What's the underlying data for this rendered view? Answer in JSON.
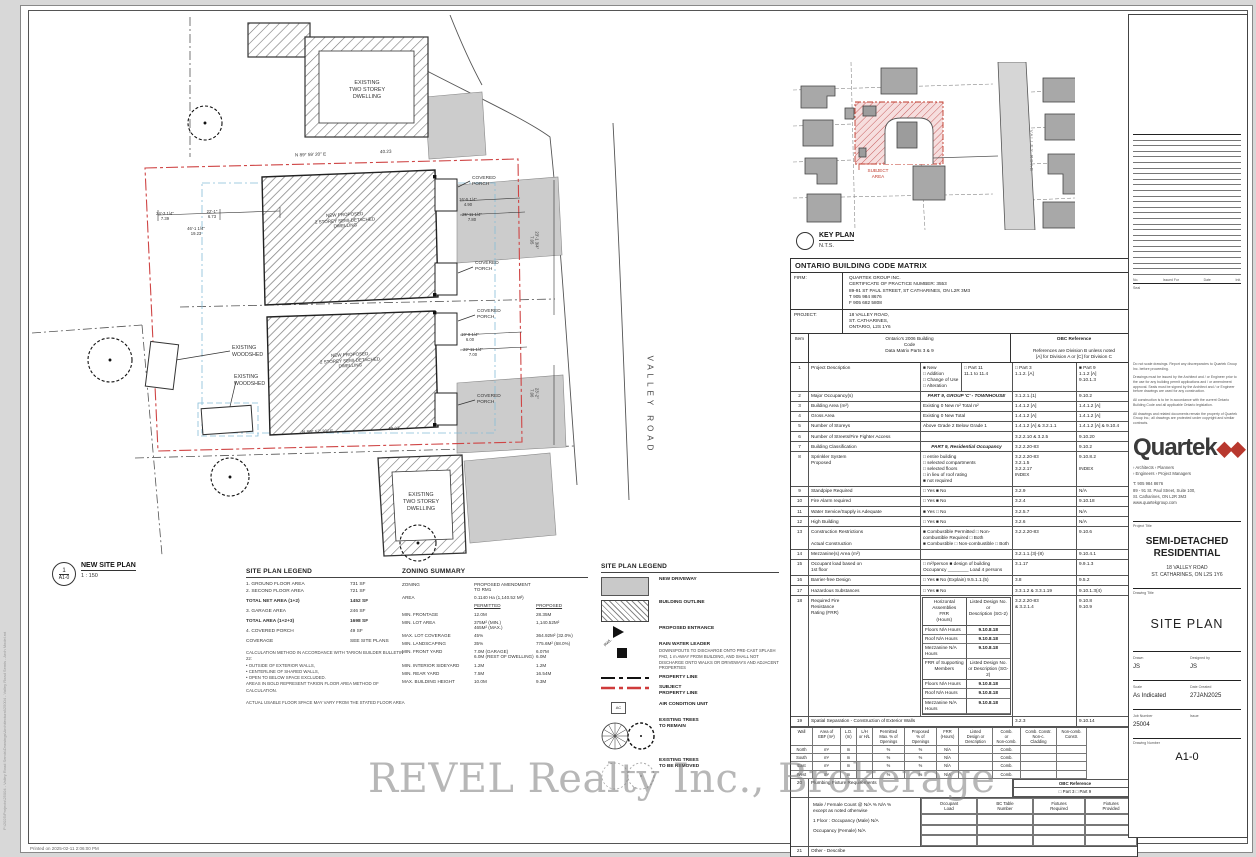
{
  "sheet": {
    "watermark": "REVEL Realty Inc., Brokerage",
    "printed_note": "Printed on  2025-02-11 2:06:00 PM",
    "side_file_text": "P:\\2025\\Projects\\25004 - Valley Road Semis\\Drawings\\Architectural\\25004 - Valley Road Semis - Arch Model.rvt"
  },
  "plan": {
    "marker_no": "1",
    "marker_sheet": "A1-0",
    "title": "NEW SITE PLAN",
    "scale": "1 : 150",
    "annotations": [
      {
        "t": "EXISTING\nTWO STOREY\nDWELLING",
        "x": 367,
        "y": 80,
        "fs": 5.4,
        "align": "center"
      },
      {
        "t": "EXISTING\nTWO STOREY\nDWELLING",
        "x": 421,
        "y": 492,
        "fs": 5.4,
        "align": "center"
      },
      {
        "t": "NEW PROPOSED\n2 STOREY SEMI-DETACHED\nDWELLING",
        "x": 345,
        "y": 212,
        "fs": 4.5,
        "rot": -3,
        "align": "center"
      },
      {
        "t": "NEW PROPOSED\n2 STOREY SEMI-DETACHED\nDWELLING",
        "x": 350,
        "y": 352,
        "fs": 4.5,
        "rot": -3,
        "align": "center"
      },
      {
        "t": "EXISTING\nWOODSHED",
        "x": 232,
        "y": 345,
        "fs": 5.2
      },
      {
        "t": "EXISTING\nWOODSHED",
        "x": 234,
        "y": 374,
        "fs": 5.2
      },
      {
        "t": "COVERED\nPORCH",
        "x": 472,
        "y": 176,
        "fs": 4.8
      },
      {
        "t": "COVERED\nPORCH",
        "x": 475,
        "y": 261,
        "fs": 4.8
      },
      {
        "t": "COVERED\nPORCH",
        "x": 477,
        "y": 309,
        "fs": 4.8
      },
      {
        "t": "COVERED\nPORCH",
        "x": 477,
        "y": 394,
        "fs": 4.8
      },
      {
        "t": "VALLEY ROAD",
        "x": 600,
        "y": 400,
        "fs": 8,
        "rot": 90,
        "ls": 4,
        "color": "#444"
      },
      {
        "t": "N 89° 59' 20\" E",
        "x": 295,
        "y": 152,
        "fs": 4.6,
        "rot": -2
      },
      {
        "t": "40.23",
        "x": 380,
        "y": 149,
        "fs": 4.6,
        "rot": -2
      },
      {
        "t": "N 89° 57' 30\" E",
        "x": 302,
        "y": 429,
        "fs": 4.6,
        "rot": -2
      },
      {
        "t": "40.23",
        "x": 388,
        "y": 426,
        "fs": 4.6,
        "rot": -2
      },
      {
        "t": "24'-3 1/4\"\n7.39",
        "x": 165,
        "y": 211,
        "fs": 4.2,
        "align": "center"
      },
      {
        "t": "22'-1\"\n6.73",
        "x": 212,
        "y": 209,
        "fs": 4.2,
        "align": "center"
      },
      {
        "t": "46'-1 1/4\"\n19.23",
        "x": 196,
        "y": 226,
        "fs": 4.2,
        "align": "center"
      },
      {
        "t": "16'-5 1/4\"\n4.90",
        "x": 468,
        "y": 197,
        "fs": 4.2,
        "align": "center"
      },
      {
        "t": "25'-11 1/4\"\n7.80",
        "x": 472,
        "y": 212,
        "fs": 4.2,
        "align": "center"
      },
      {
        "t": "19'-8 1/4\"\n6.00",
        "x": 470,
        "y": 332,
        "fs": 4.2,
        "align": "center"
      },
      {
        "t": "22'-11 1/4\"\n7.00",
        "x": 473,
        "y": 347,
        "fs": 4.2,
        "align": "center"
      },
      {
        "t": "23'-1 3/4\"\n7.05",
        "x": 534,
        "y": 235,
        "fs": 4.2,
        "rot": 90,
        "align": "center"
      },
      {
        "t": "23'-2\"\n7.06",
        "x": 534,
        "y": 388,
        "fs": 4.2,
        "rot": 90,
        "align": "center"
      },
      {
        "t": "SUBJECT\nAREA",
        "x": 878,
        "y": 168,
        "fs": 4.6,
        "color": "#c0392b",
        "align": "center"
      },
      {
        "t": "VALLEY ROAD",
        "x": 1010,
        "y": 148,
        "fs": 4.6,
        "rot": 90,
        "color": "#777",
        "ls": 1
      }
    ]
  },
  "key_plan": {
    "title": "KEY PLAN",
    "scale": "N.T.S."
  },
  "area_legend": {
    "title": "SITE PLAN LEGEND",
    "rows": [
      {
        "label": "1. GROUND FLOOR AREA",
        "value": "731 SF",
        "bold": false,
        "gap": false
      },
      {
        "label": "2. SECOND FLOOR AREA",
        "value": "721 SF",
        "bold": false,
        "gap": false
      },
      {
        "label": "TOTAL NET AREA (1+2)",
        "value": "1452 SF",
        "bold": true,
        "gap": true
      },
      {
        "label": "3. GARAGE AREA",
        "value": "246 SF",
        "bold": false,
        "gap": true
      },
      {
        "label": "TOTAL AREA (1+2+3)",
        "value": "1698 SF",
        "bold": true,
        "gap": true
      },
      {
        "label": "4. COVERED PORCH",
        "value": "49 SF",
        "bold": false,
        "gap": true
      },
      {
        "label": "COVERAGE",
        "value": "SEE SITE PLANS",
        "bold": false,
        "gap": true
      }
    ],
    "notes": "CALCULATION METHOD IN ACCORDANCE WITH TARION BUILDER BULLETIN 22:\n•   OUTSIDE OF EXTERIOR WALLS,\n•   CENTERLINE OF SHARED WALLS,\n•   OPEN TO BELOW SPACE EXCLUDED.\nAREAS IN BOLD REPRESENT TARION FLOOR AREA METHOD OF CALCULATION.\n\nACTUAL USABLE FLOOR SPACE MAY VARY FROM THE STATED FLOOR AREA"
  },
  "zoning": {
    "title": "ZONING SUMMARY",
    "col_permitted": "PERMITTED",
    "col_proposed": "PROPOSED",
    "rows": [
      {
        "label": "ZONING",
        "permitted": "PROPOSED AMENDMENT TO RM1",
        "proposed": ""
      },
      {
        "label": "AREA",
        "permitted": "0.1140 Ha (1,140.52 M²)",
        "proposed": ""
      },
      {
        "label": "MIN. FRONTAGE",
        "permitted": "12.0M",
        "proposed": "28.35M"
      },
      {
        "label": "MIN. LOT AREA",
        "permitted": "375M² (MIN.)\n465M² (MAX.)",
        "proposed": "1,140.52M²"
      },
      {
        "label": "MAX. LOT COVERAGE",
        "permitted": "45%",
        "proposed": "364.92M² (32.0%)"
      },
      {
        "label": "MIN. LANDSCAPING",
        "permitted": "35%",
        "proposed": "775.6M² (68.0%)"
      },
      {
        "label": "MIN. FRONT YARD",
        "permitted": "7.0M (GARAGE)\n6.0M (REST OF DWELLING)",
        "proposed": "6.07M\n6.0M"
      },
      {
        "label": "MIN. INTERIOR SIDEYARD",
        "permitted": "1.2M",
        "proposed": "1.2M"
      },
      {
        "label": "MIN. REAR YARD",
        "permitted": "7.5M",
        "proposed": "16.54M"
      },
      {
        "label": "MAX. BUILDING HEIGHT",
        "permitted": "10.0M",
        "proposed": "9.3M"
      }
    ]
  },
  "symbols_legend": {
    "title": "SITE PLAN LEGEND",
    "items": [
      {
        "type": "driveway",
        "label": "NEW DRIVEWAY",
        "note": ""
      },
      {
        "type": "hatch",
        "label": "BUILDING OUTLINE",
        "note": ""
      },
      {
        "type": "triangle",
        "label": "PROPOSED ENTRANCE",
        "note": ""
      },
      {
        "type": "rwl",
        "label": "RAIN WATER LEADER",
        "note": "DOWNSPOUTS TO DISCHARGE ONTO PRE-CAST SPLASH PAD, 1 m AWAY FROM BUILDING, AND SHALL NOT DISCHARGE ONTO WALKS OR DRIVEWAYS AND ADJACENT PROPERTIES"
      },
      {
        "type": "property-line",
        "label": "PROPERTY LINE",
        "note": ""
      },
      {
        "type": "subject-line",
        "label": "SUBJECT\nPROPERTY LINE",
        "note": ""
      },
      {
        "type": "ac",
        "label": "AIR CONDITION UNIT",
        "note": ""
      },
      {
        "type": "trees-remain",
        "label": "EXISTING TREES\nTO REMAIN",
        "note": ""
      },
      {
        "type": "trees-removed",
        "label": "EXISTING TREES\nTO BE REMOVED",
        "note": ""
      }
    ]
  },
  "obc_matrix": {
    "title": "ONTARIO BUILDING CODE MATRIX",
    "firm_label": "FIRM:",
    "firm": "QUARTEK GROUP INC.\nCERTIFICATE OF PRACTICE NUMBER: 3553\n89-91 ST PAUL STREET, ST CATHARINES, ON L2R 3M3\nT 905 984 8676\nF 905 682 5808",
    "project_label": "PROJECT:",
    "project": "18 VALLEY ROAD,\nST. CATHARINES,\nONTARIO, L2S 1Y6",
    "col_item": "Item",
    "col_code": "Ontario's 2006 Building\nCode\nData Matrix Parts 3 & 9",
    "col_ref": "OBC Reference",
    "col_ref_note": "References are Division B unless noted\n[A] for Division A or [C] for Division C",
    "rows": [
      {
        "no": "1",
        "label": "Project Description",
        "mid": "■ New\n□ Addition\n□ Change of Use    □ Alteration",
        "extra": "□ Part 11\n11.1 to 11.4",
        "ref3": "□ Part 3\n1.1.2. [A]",
        "ref9": "■ Part 9\n1.1.2 [A]\n9.10.1.3"
      },
      {
        "no": "2",
        "label": "Major Occupancy(s)",
        "mid": "PART 9, GROUP 'C' - TOWNHOUSE",
        "ital": true,
        "ref3": "3.1.2.1.(1)",
        "ref9": "9.10.2"
      },
      {
        "no": "3",
        "label": "Building Area (m²)",
        "mid": "Existing   0        New    m²        Total    m²",
        "ref3": "1.4.1.2 [A]",
        "ref9": "1.4.1.2 [A]"
      },
      {
        "no": "4",
        "label": "Gross Area",
        "mid": "Existing   0        New        Total",
        "ref3": "1.4.1.2 [A]",
        "ref9": "1.4.1.2 [A]"
      },
      {
        "no": "5",
        "label": "Number of Storeys",
        "mid": "Above Grade   2        Below Grade   1",
        "ref3": "1.4.1.2 [A] & 3.2.1.1",
        "ref9": "1.4.1.2 [A] & 9.10.4"
      },
      {
        "no": "6",
        "label": "Number of Streets/Fire Fighter Access",
        "mid": "",
        "ref3": "3.2.2.10 & 3.2.5",
        "ref9": "9.10.20"
      },
      {
        "no": "7",
        "label": "Building Classification",
        "mid": "PART 9, Residential Occupancy",
        "ital": true,
        "ref3": "3.2.2.20-83",
        "ref9": "9.10.2"
      },
      {
        "no": "8",
        "label": "Sprinkler System\nProposed",
        "mid": "□ entire building\n□ selected compartments\n□ selected floors\n□ in lieu of roof rating\n■ not required",
        "ref3": "3.2.2.20-83\n3.2.1.5\n3.2.2.17\nINDEX",
        "ref9": "9.10.8.2\n\nINDEX"
      },
      {
        "no": "9",
        "label": "Standpipe Required",
        "mid": "□ Yes    ■ No",
        "ref3": "3.2.9",
        "ref9": "N/A"
      },
      {
        "no": "10",
        "label": "Fire Alarm required",
        "mid": "□ Yes    ■ No",
        "ref3": "3.2.4",
        "ref9": "9.10.18"
      },
      {
        "no": "11",
        "label": "Water Service/Supply is Adequate",
        "mid": "■ Yes    □ No",
        "ref3": "3.2.5.7",
        "ref9": "N/A"
      },
      {
        "no": "12",
        "label": "High Building",
        "mid": "□ Yes    ■ No",
        "ref3": "3.2.6",
        "ref9": "N/A"
      },
      {
        "no": "13",
        "label": "Construction Restrictions\n\nActual Construction",
        "mid": "■ Combustible Permitted   □ Non-combustible Required   □ Both\n■ Combustible   □ Non-combustible   □ Both",
        "ref3": "3.2.2.20-83",
        "ref9": "9.10.6"
      },
      {
        "no": "14",
        "label": "Mezzanine(s) Area (m²)",
        "mid": "",
        "ref3": "3.2.1.1.(3)-(8)",
        "ref9": "9.10.4.1"
      },
      {
        "no": "15",
        "label": "Occupant load based on\n1st floor",
        "mid": "□ m²/person    ■ design of building\nOccupancy ________     Load    4    persons",
        "ref3": "3.1.17",
        "ref9": "9.9.1.3"
      },
      {
        "no": "16",
        "label": "Barrier-free Design",
        "mid": "□ Yes    ■ No   (Explain)   9.5.1.1.(5)",
        "ref3": "3.8",
        "ref9": "9.5.2"
      },
      {
        "no": "17",
        "label": "Hazardous Substances",
        "mid": "□ Yes    ■ No",
        "ref3": "3.3.1.2 & 3.3.1.19",
        "ref9": "9.10.1.3(4)"
      }
    ],
    "frr": {
      "no": "18",
      "label": "Required Fire\nResistance\nRating (FRR)",
      "head1": "Horizontal Assemblies\nFRR\n(Hours)",
      "head2": "Listed Design No.\nor\nDescription (SG-2)",
      "rows1": [
        [
          "Floors",
          "N/A",
          "Hours",
          "9.10.8.18"
        ],
        [
          "Roof",
          "N/A",
          "Hours",
          "9.10.8.18"
        ],
        [
          "Mezzanine",
          "N/A",
          "Hours",
          "9.10.8.18"
        ]
      ],
      "head3": "FRR of Supporting\nMembers",
      "head4": "Listed Design No.\nor Description (SG-2)",
      "rows2": [
        [
          "Floors",
          "N/A",
          "Hours",
          "9.10.8.18"
        ],
        [
          "Roof",
          "N/A",
          "Hours",
          "9.10.8.18"
        ],
        [
          "Mezzanine",
          "N/A",
          "Hours",
          "9.10.8.18"
        ]
      ],
      "ref3": "3.2.2.20-83\n& 3.2.1.4",
      "ref9": "9.10.8\n9.10.9"
    },
    "walls": {
      "no": "19",
      "label": "Spatial Separation - Construction of Exterior Walls",
      "ref3": "3.2.3",
      "ref9": "9.10.14",
      "cols": [
        "Wall",
        "Area of\nEBF (m²)",
        "L.D.\n(m)",
        "L/H\nor H/L",
        "Permitted\nMax. % of\nOpenings",
        "Proposed\n% of\nOpenings",
        "FRR\n(Hours)",
        "Listed\nDesign or\nDescription",
        "Comb.\nor\nNon-comb.",
        "Comb. Constr.\nNon-c.\nCladding",
        "Non-comb.\nConstr."
      ],
      "rows": [
        [
          "North",
          "m²",
          "m",
          "",
          "%",
          "%",
          "N/A",
          "",
          "Comb.",
          "",
          ""
        ],
        [
          "South",
          "m²",
          "m",
          "",
          "%",
          "%",
          "N/A",
          "",
          "Comb.",
          "",
          ""
        ],
        [
          "East",
          "m²",
          "m",
          "",
          "%",
          "%",
          "N/A",
          "",
          "Comb.",
          "",
          ""
        ],
        [
          "West",
          "m²",
          "m",
          "",
          "%",
          "%",
          "N/A",
          "",
          "Comb.",
          "",
          ""
        ]
      ]
    },
    "plumbing": {
      "no": "20",
      "label": "Plumbing Fixture Requirements",
      "obc_ref": "OBC Reference",
      "parts": "□ Part 3      □ Part 9",
      "note": "Male / Female Count @   N/A %   N/A %\nexcept as noted otherwise",
      "floor_rows": [
        "1 Floor : Occupancy (Male)      N/A",
        "Occupancy (Female)      N/A"
      ],
      "cols": [
        "Occupant\nLoad",
        "BC Table\nNumber",
        "Fixtures\nRequired",
        "Fixtures\nProvided"
      ]
    },
    "other": {
      "no": "21",
      "label": "Other - Describe"
    }
  },
  "title_block": {
    "rev_cols": [
      "No.",
      "Issued For",
      "Date",
      "Init."
    ],
    "seal_label": "Seal",
    "notes": [
      "Do not scale drawings. Report any discrepancies to Quartek Group Inc. before proceeding.",
      "Drawings must be issued by the Architect and / or Engineer prior to the use for any building permit applications and / or amendment approval. Seals must be signed by the Architect and / or Engineer before drawings are used for any construction.",
      "All construction is to be in accordance with the current Ontario Building Code and all applicable Ontario legislation.",
      "All drawings and related documents remain the property of Quartek Group Inc.; all drawings are protected under copyright and similar contracts."
    ],
    "logo_text": "Quartek",
    "logo_mark": "◆◆",
    "services": "› Architects      › Planners\n› Engineers      › Project Managers",
    "contact": "T:   905 984 8676\n89 - 91 St. Paul Street, Suite 100,\nSt. Catharines, ON L2R 3M3\nwww.quartekgroup.com",
    "project_title_label": "Project Title",
    "project_name": "SEMI-DETACHED\nRESIDENTIAL",
    "project_address": "18 VALLEY ROAD\nST. CATHARINES, ON  L2S 1Y6",
    "drawing_title_label": "Drawing Title",
    "drawing_name": "SITE PLAN",
    "drawn_label": "Drawn",
    "drawn": "JS",
    "designed_label": "Designed by",
    "designed": "JS",
    "scale_label": "Scale",
    "scale": "As Indicated",
    "date_label": "Date Created",
    "date": "27JAN2025",
    "job_label": "Job Number",
    "job": "25004",
    "issue_label": "Issue",
    "issue": "",
    "dwgno_label": "Drawing Number",
    "dwgno": "A1-0"
  }
}
